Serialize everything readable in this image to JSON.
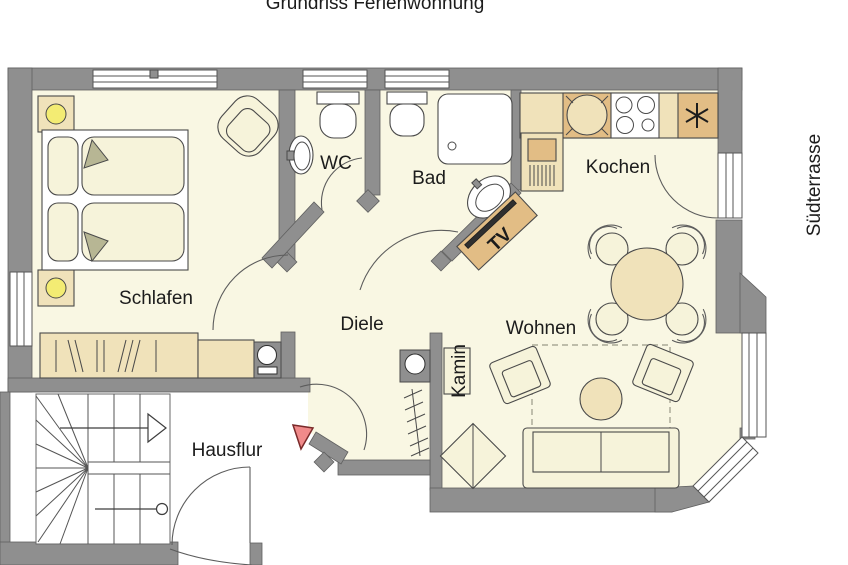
{
  "title": "Grundriss Ferienwohnung",
  "labels": {
    "schlafen": "Schlafen",
    "wc": "WC",
    "bad": "Bad",
    "kochen": "Kochen",
    "diele": "Diele",
    "wohnen": "Wohnen",
    "hausflur": "Hausflur",
    "kamin": "Kamin",
    "tv": "TV",
    "suedterrasse": "Südterrasse"
  },
  "colors": {
    "wall": "#8f8f8f",
    "floor": "#f9f7e3",
    "furniture_light": "#f6f3da",
    "furniture_tan": "#f0e2ba",
    "furniture_tan_dark": "#e2bd85",
    "lamp_yellow": "#f3ec73",
    "entrance_marker": "#f08a8a",
    "fold_olive": "#b7b694"
  }
}
